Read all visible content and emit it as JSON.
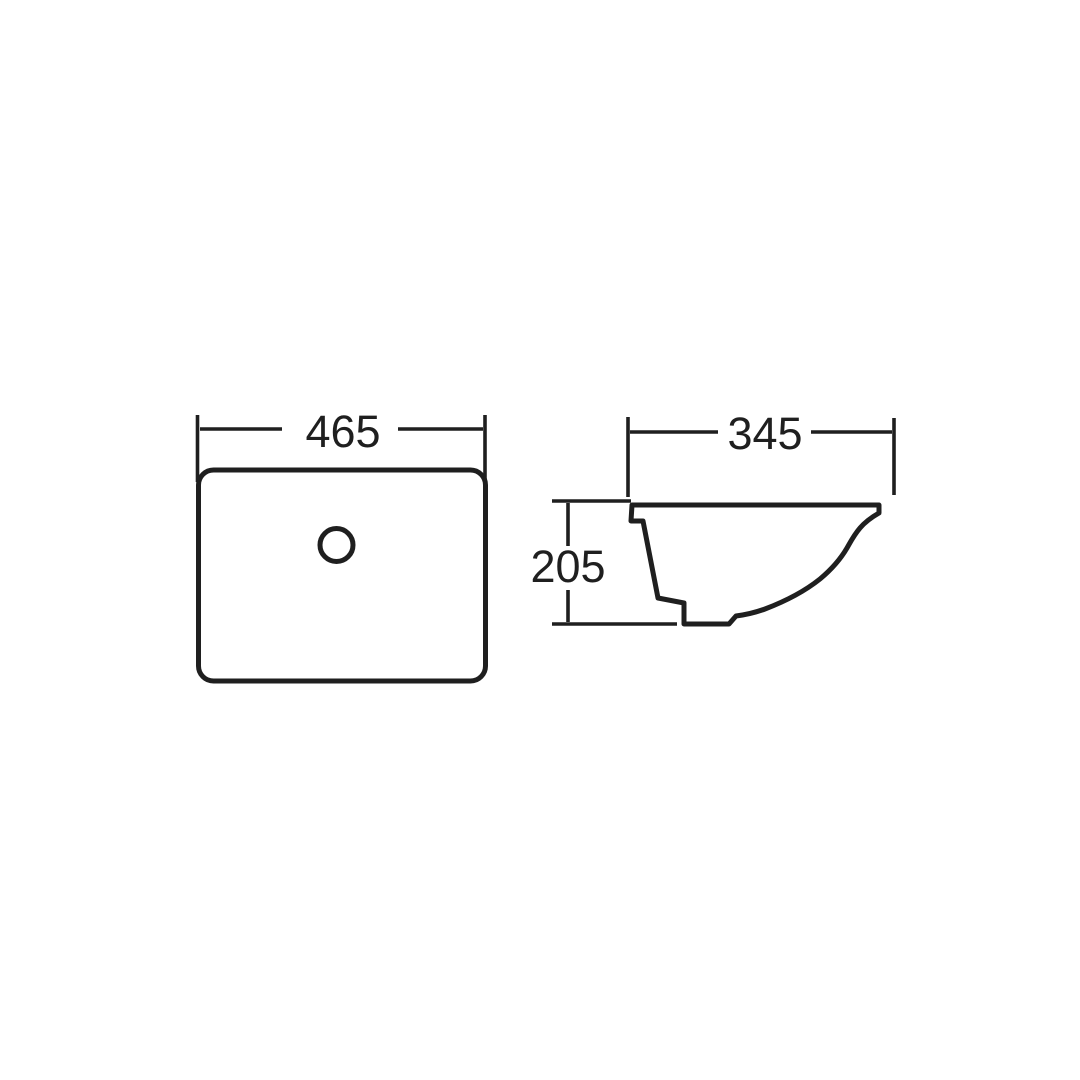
{
  "colors": {
    "background": "#ffffff",
    "line": "#1f1f1f"
  },
  "drawing": {
    "top_view": {
      "width_label": "465"
    },
    "side_view": {
      "depth_label": "345",
      "height_label": "205"
    }
  }
}
